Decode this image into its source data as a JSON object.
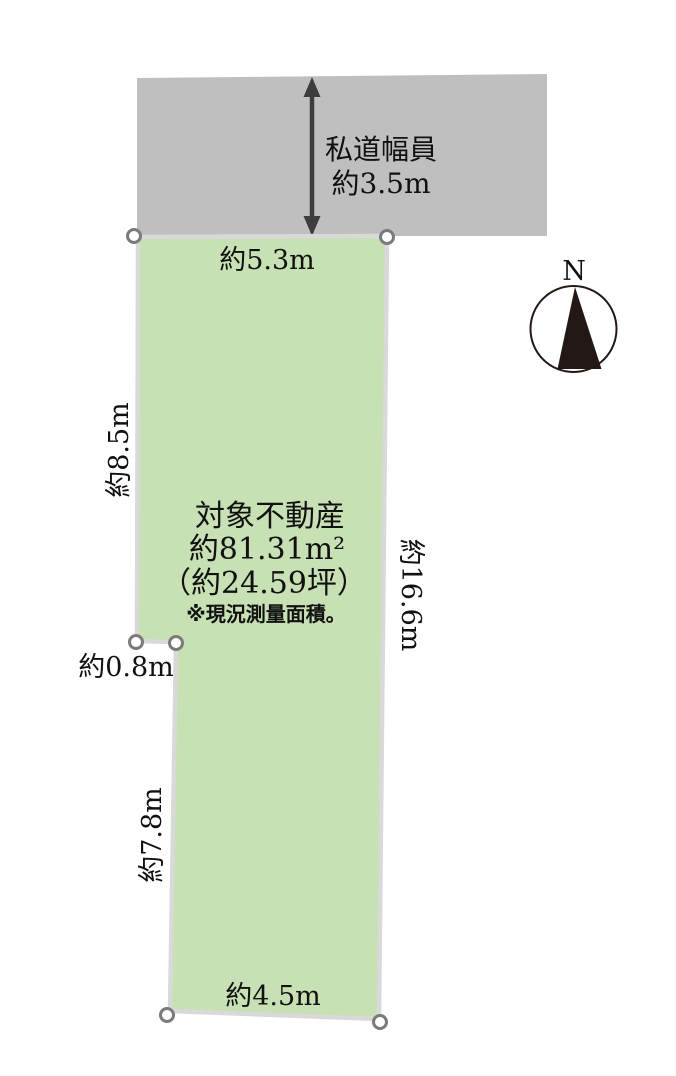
{
  "diagram": {
    "road": {
      "label_line1": "私道幅員",
      "label_line2": "約3.5m"
    },
    "property": {
      "title": "対象不動産",
      "area_m2": "約81.31m²",
      "area_tsubo": "（約24.59坪）",
      "note": "※現況測量面積。"
    },
    "dimensions": {
      "top": "約5.3m",
      "left_upper": "約8.5m",
      "notch": "約0.8m",
      "left_lower": "約7.8m",
      "right": "約16.6m",
      "bottom": "約4.5m"
    },
    "compass": {
      "north_label": "N"
    }
  },
  "colors": {
    "lot_fill": "#c7e0b4",
    "lot_outline": "#d9d9d9",
    "road_fill": "#bfbfbf",
    "marker_fill": "#ffffff",
    "marker_stroke": "#7a7a7a",
    "arrow": "#3d3d3d",
    "compass_ink": "#231815",
    "compass_fill": "#ffffff"
  }
}
